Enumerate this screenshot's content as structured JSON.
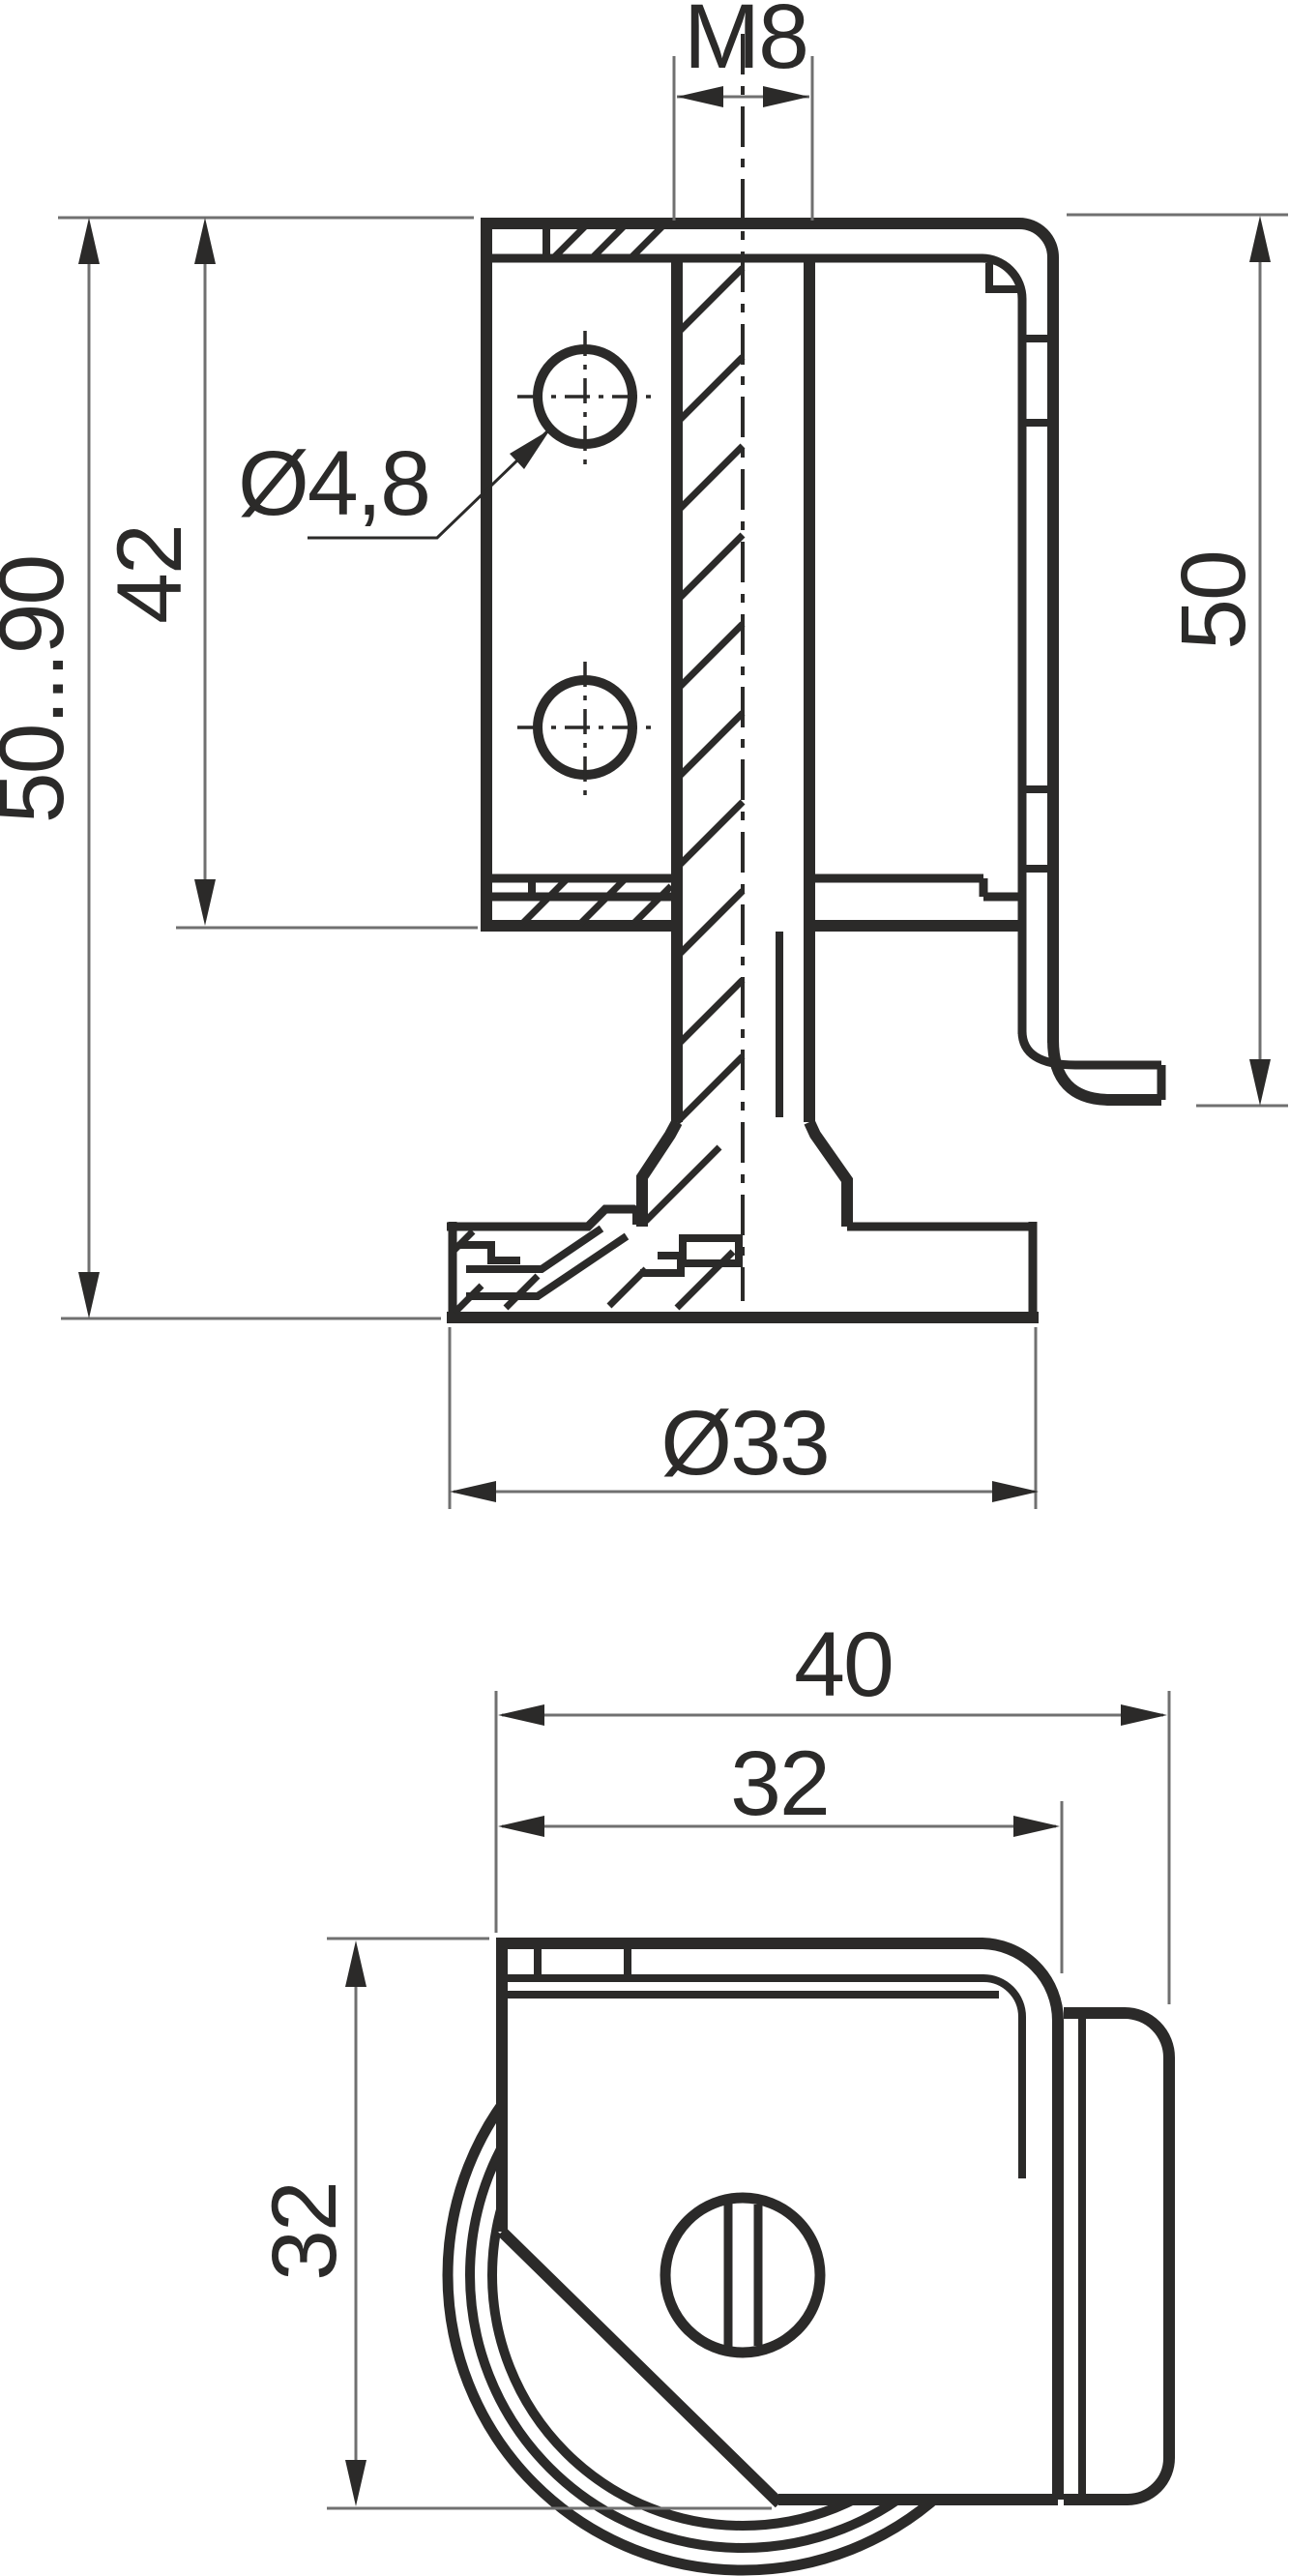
{
  "drawing": {
    "background": "#ffffff",
    "line_color": "#2b2a29",
    "dim_color": "#707070",
    "front_view": {
      "thread_label": "M8",
      "hole_label": "Ø4,8",
      "hole_pitch": "42",
      "adjust_range": "50...90",
      "side_height": "50",
      "base_dia": "Ø33"
    },
    "bottom_view": {
      "overall_width": "40",
      "body_width": "32",
      "body_height": "32"
    }
  }
}
